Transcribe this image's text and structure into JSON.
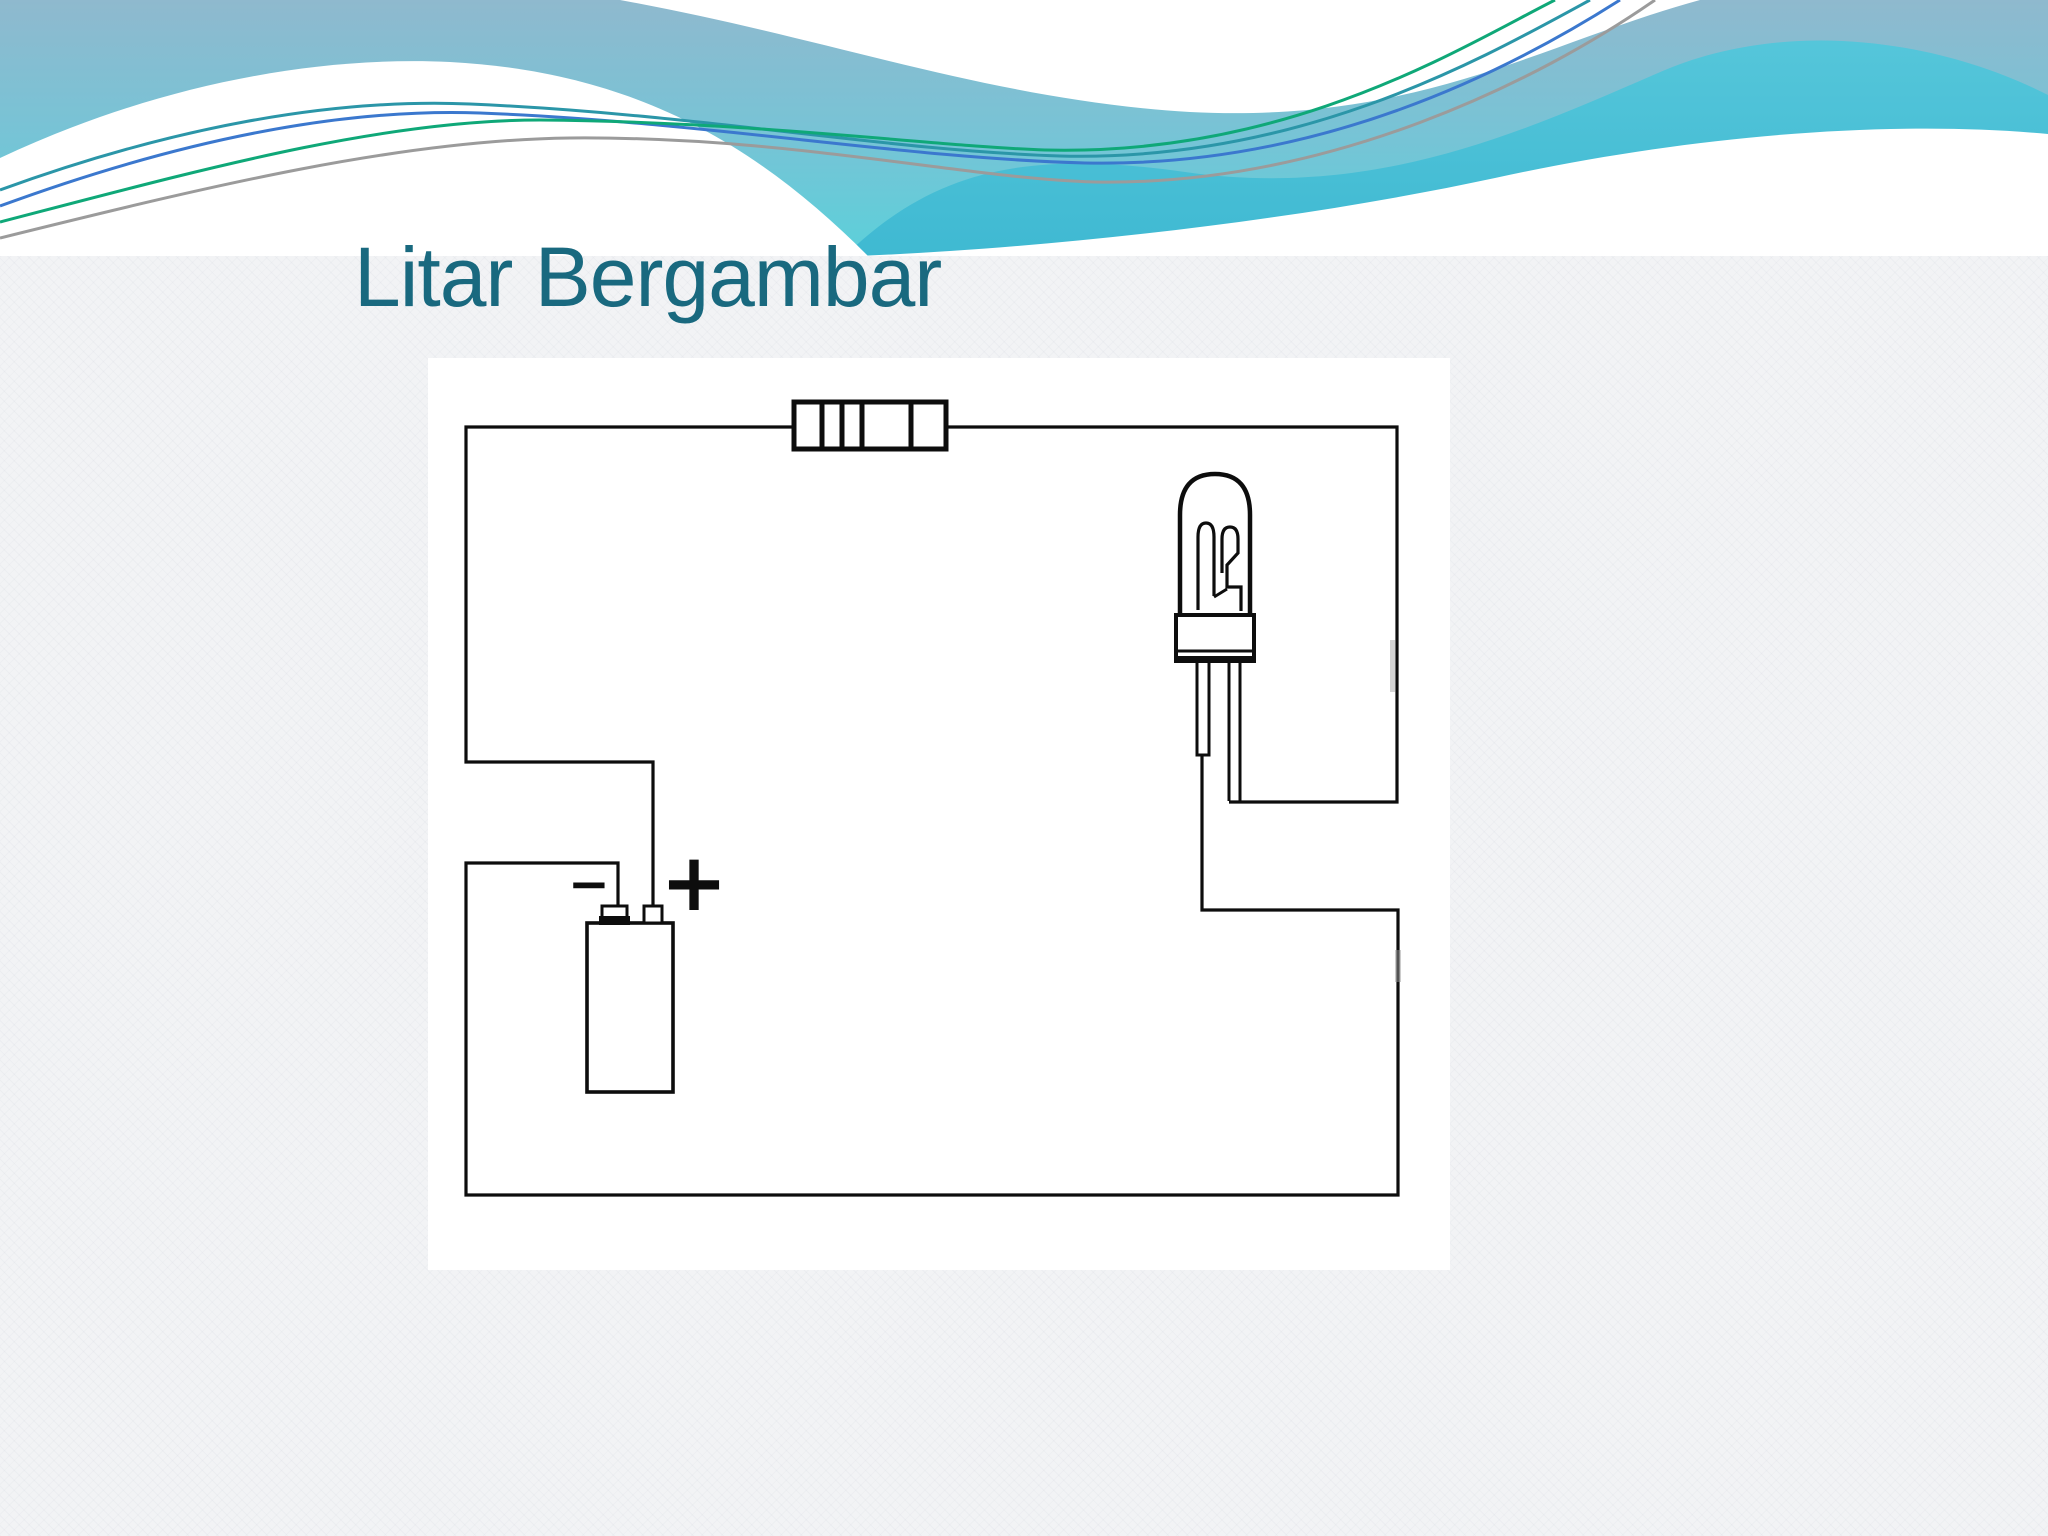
{
  "slide": {
    "title": "Litar Bergambar"
  },
  "circuit": {
    "battery": {
      "negative_label": "−",
      "positive_label": "+"
    },
    "components": {
      "resistor": "resistor-fuse-block",
      "bulb": "incandescent-bulb",
      "battery": "battery-cell"
    }
  },
  "colors": {
    "title_text": "#19697f",
    "wire": "#0d0d0d",
    "slide_background": "#f2f3f5",
    "panel_background": "#ffffff",
    "header_gradient_top": "#8fb9ce",
    "header_gradient_bottom": "#5bd0da",
    "header_band": "#48bfd6",
    "accent_line_teal": "#2b96a8",
    "accent_line_blue": "#3b78ce",
    "accent_line_green": "#0fa878",
    "accent_line_gray": "#9b9b9b"
  }
}
